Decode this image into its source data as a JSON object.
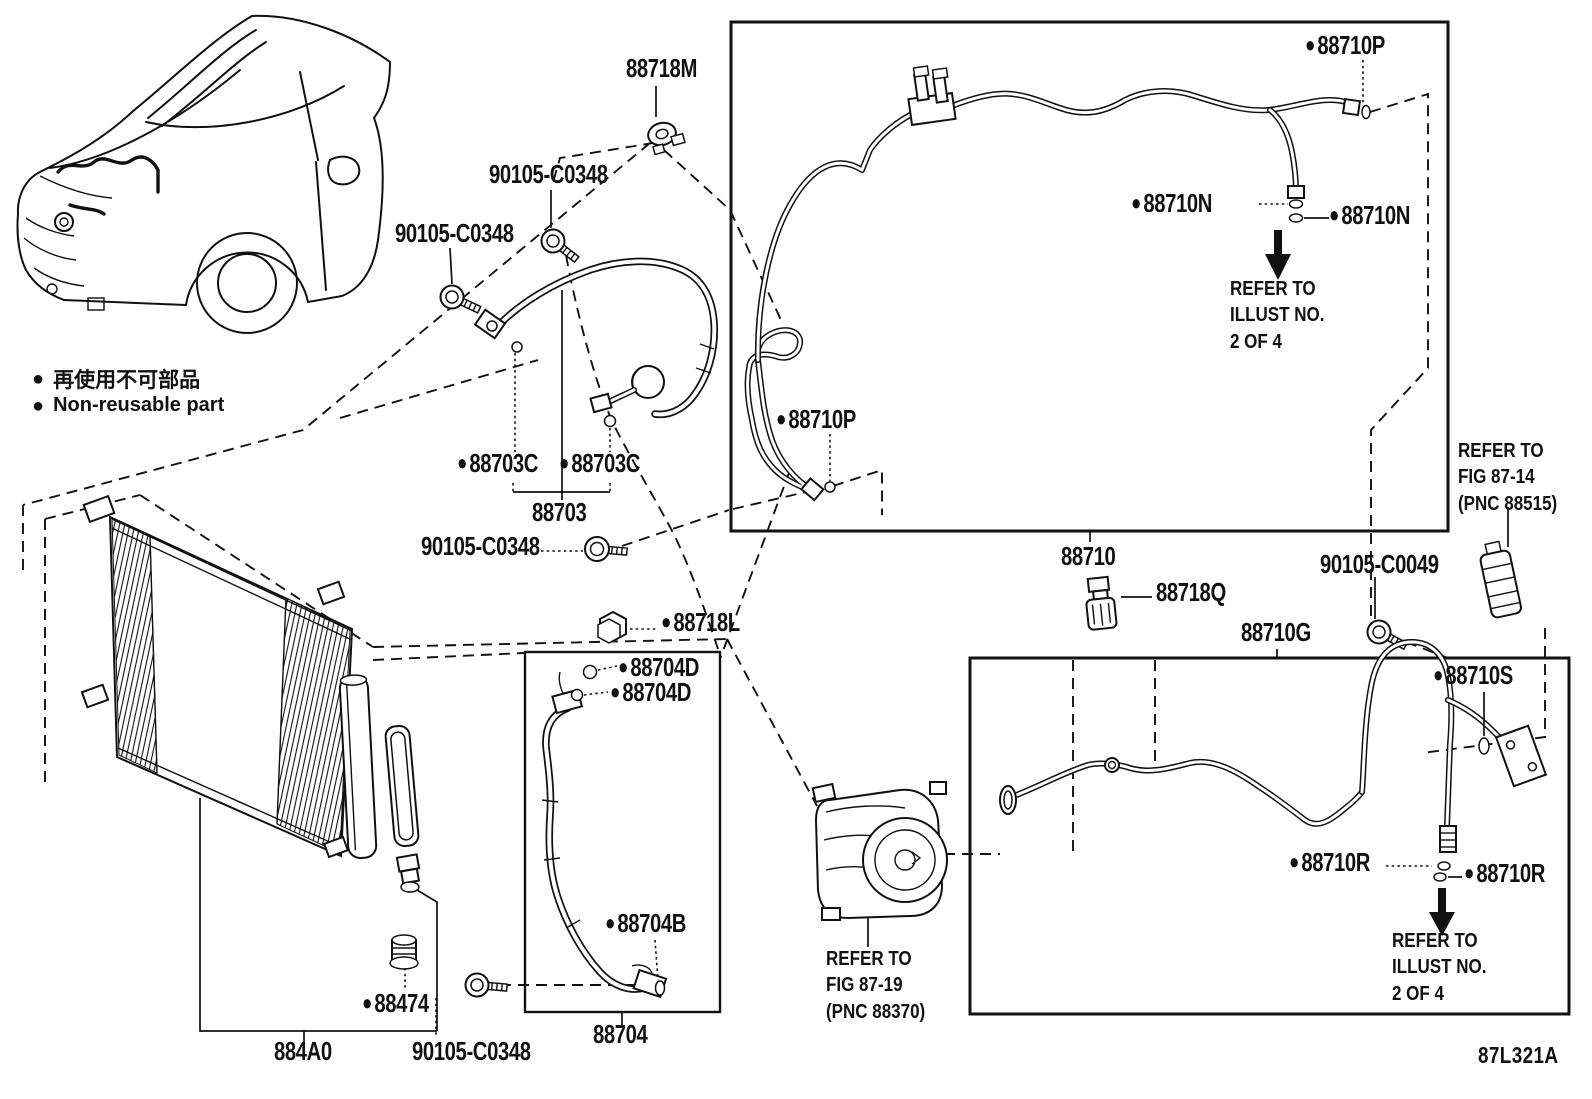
{
  "page": {
    "background": "#ffffff",
    "ink": "#111111",
    "drawing_code": "87L321A"
  },
  "icons": {
    "non_reusable_dot": "●"
  },
  "legend": {
    "jp": "再使用不可部品",
    "en": "Non-reusable part"
  },
  "notes": {
    "illust_top": "REFER TO\nILLUST NO.\n2 OF 4",
    "fig_87_14": "REFER TO\nFIG 87-14\n(PNC 88515)",
    "illust_bottom": "REFER TO\nILLUST NO.\n2 OF 4",
    "fig_87_19": "REFER TO\nFIG 87-19\n(PNC 88370)"
  },
  "parts": {
    "clamp_88718M": "88718M",
    "bolt_90105_C0348": "90105-C0348",
    "bolt_90105_C0049": "90105-C0049",
    "packing_88703C": "88703C",
    "hose_88703": "88703",
    "pipe_88710": "88710",
    "ring_88710P": "88710P",
    "ring_88710N": "88710N",
    "clip_88718Q": "88718Q",
    "pipe_88710G": "88710G",
    "ring_88710S": "88710S",
    "ring_88710R": "88710R",
    "nut_88718L": "88718L",
    "ring_88704D": "88704D",
    "ring_88704B": "88704B",
    "hose_88704": "88704",
    "cap_88474": "88474",
    "condenser_884A0": "884A0"
  }
}
